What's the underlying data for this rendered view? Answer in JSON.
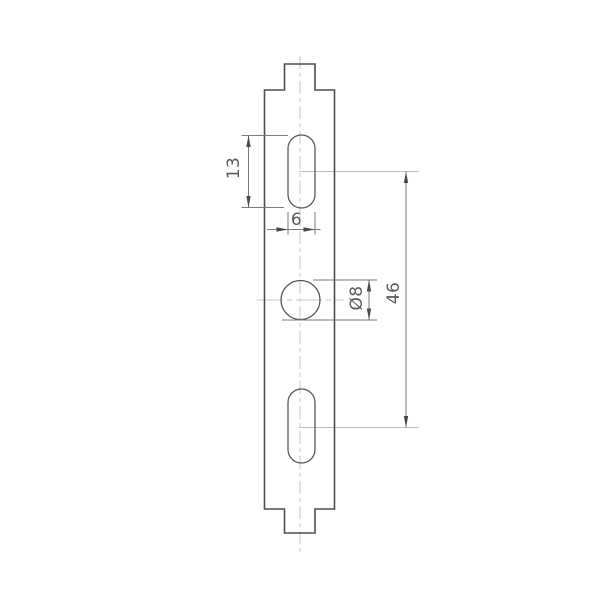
{
  "drawing": {
    "kind": "technical-drawing-front-view",
    "part": "mounting-strap-plate",
    "dimension_labels": {
      "slot_length": "13",
      "slot_width": "6",
      "hole_diameter": "Ø8",
      "hole_spacing": "46"
    },
    "colors": {
      "background": "#ffffff",
      "outline": "#4d4d4d",
      "hole_outline": "#585858",
      "dimension": "#7a7a7a",
      "arrow": "#4a4a4a",
      "label_text": "#5a5a5a",
      "centerline": "#c7c7c7",
      "extension_light": "#bdbdbd"
    }
  }
}
